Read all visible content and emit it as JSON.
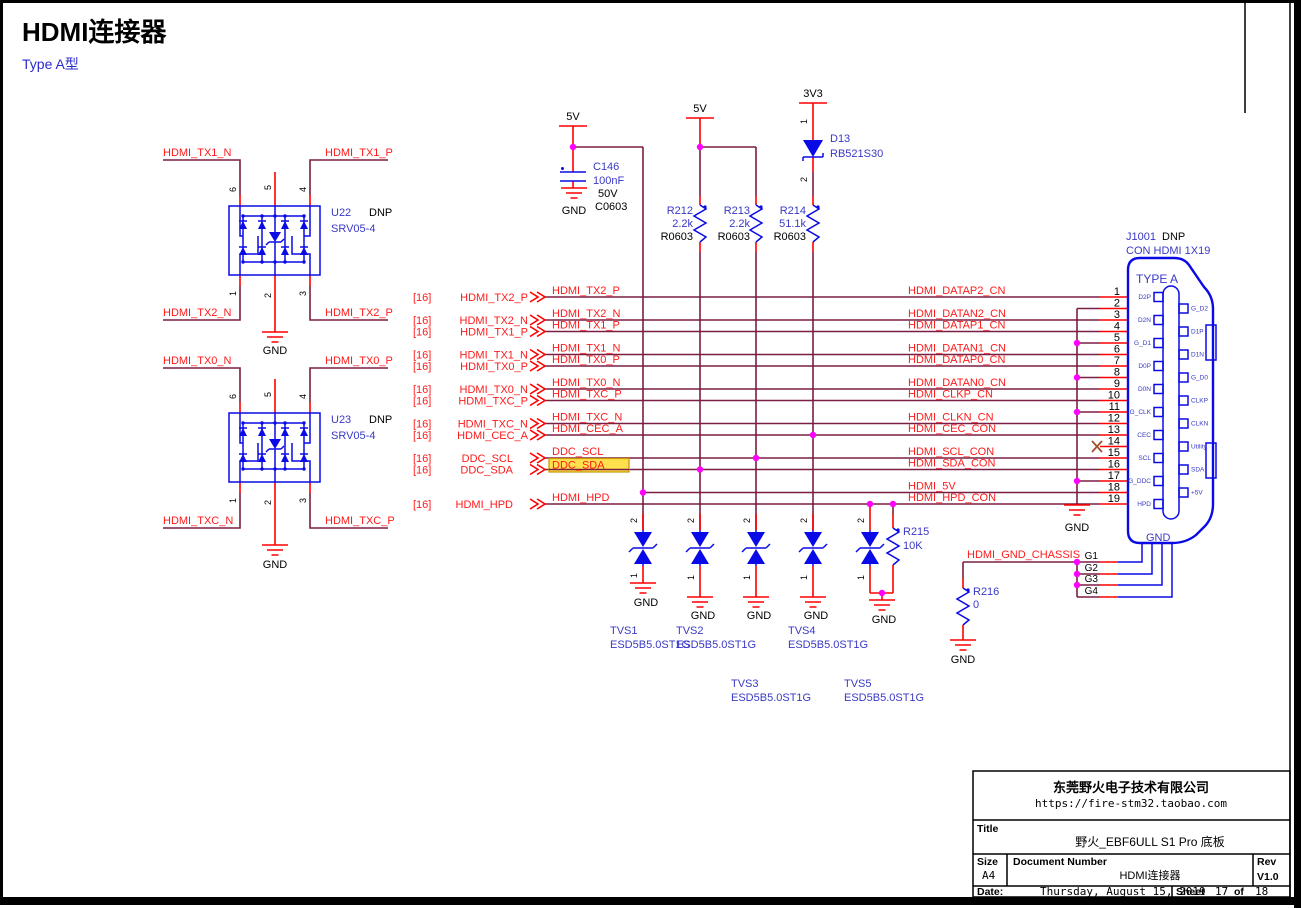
{
  "header": {
    "title": "HDMI连接器",
    "subtitle": "Type A型"
  },
  "labels": {
    "gnd": "GND",
    "dnp": "DNP"
  },
  "power": {
    "v5": "5V",
    "v3v3": "3V3"
  },
  "srv_pins": {
    "p6": "6",
    "p5": "5",
    "p4": "4",
    "p1": "1",
    "p2": "2",
    "p3": "3"
  },
  "u22": {
    "ref": "U22",
    "part": "SRV05-4",
    "net_tl": "HDMI_TX1_N",
    "net_tr": "HDMI_TX1_P",
    "net_bl": "HDMI_TX2_N",
    "net_br": "HDMI_TX2_P"
  },
  "u23": {
    "ref": "U23",
    "part": "SRV05-4",
    "net_tl": "HDMI_TX0_N",
    "net_tr": "HDMI_TX0_P",
    "net_bl": "HDMI_TXC_N",
    "net_br": "HDMI_TXC_P"
  },
  "c146": {
    "ref": "C146",
    "value": "100nF",
    "rating": "50V",
    "footprint": "C0603"
  },
  "r212": {
    "ref": "R212",
    "value": "2.2k",
    "footprint": "R0603"
  },
  "r213": {
    "ref": "R213",
    "value": "2.2k",
    "footprint": "R0603"
  },
  "r214": {
    "ref": "R214",
    "value": "51.1k",
    "footprint": "R0603"
  },
  "r215": {
    "ref": "R215",
    "value": "10K"
  },
  "r216": {
    "ref": "R216",
    "value": "0"
  },
  "d13": {
    "ref": "D13",
    "part": "RB521S30",
    "pin1": "1",
    "pin2": "2"
  },
  "tvs": {
    "pin_top": "2",
    "pin_bottom": "1",
    "items": [
      {
        "ref": "TVS1",
        "part": "ESD5B5.0ST1G"
      },
      {
        "ref": "TVS2",
        "part": "ESD5B5.0ST1G"
      },
      {
        "ref": "TVS3",
        "part": "ESD5B5.0ST1G"
      },
      {
        "ref": "TVS4",
        "part": "ESD5B5.0ST1G"
      },
      {
        "ref": "TVS5",
        "part": "ESD5B5.0ST1G"
      }
    ]
  },
  "offpage": {
    "sheet_ref": "[16]",
    "rows": [
      {
        "name": "HDMI_TX2_P",
        "label": "HDMI_TX2_P"
      },
      {
        "name": "HDMI_TX2_N",
        "label": "HDMI_TX2_N"
      },
      {
        "name": "HDMI_TX1_P",
        "label": "HDMI_TX1_P"
      },
      {
        "name": "HDMI_TX1_N",
        "label": "HDMI_TX1_N"
      },
      {
        "name": "HDMI_TX0_P",
        "label": "HDMI_TX0_P"
      },
      {
        "name": "HDMI_TX0_N",
        "label": "HDMI_TX0_N"
      },
      {
        "name": "HDMI_TXC_P",
        "label": "HDMI_TXC_P"
      },
      {
        "name": "HDMI_TXC_N",
        "label": "HDMI_TXC_N"
      },
      {
        "name": "HDMI_CEC_A",
        "label": "HDMI_CEC_A"
      },
      {
        "name": "DDC_SCL",
        "label": "DDC_SCL"
      },
      {
        "name": "DDC_SDA",
        "label": "DDC_SDA"
      },
      {
        "name": "HDMI_HPD",
        "label": "HDMI_HPD"
      }
    ]
  },
  "right_nets": [
    "HDMI_DATAP2_CN",
    "HDMI_DATAN2_CN",
    "HDMI_DATAP1_CN",
    "HDMI_DATAN1_CN",
    "HDMI_DATAP0_CN",
    "HDMI_DATAN0_CN",
    "HDMI_CLKP_CN",
    "HDMI_CLKN_CN",
    "HDMI_CEC_CON",
    "HDMI_SCL_CON",
    "HDMI_SDA_CON",
    "HDMI_5V",
    "HDMI_HPD_CON"
  ],
  "chassis_net": "HDMI_GND_CHASSIS",
  "connector": {
    "ref": "J1001",
    "dnp": "DNP",
    "part": "CON HDMI 1X19",
    "type_label": "TYPE A",
    "gnd_label": "GND",
    "pins": [
      "1",
      "2",
      "3",
      "4",
      "5",
      "6",
      "7",
      "8",
      "9",
      "10",
      "11",
      "12",
      "13",
      "14",
      "15",
      "16",
      "17",
      "18",
      "19"
    ],
    "left_pads": [
      "D2P",
      "D2N",
      "G_D1",
      "D0P",
      "D0N",
      "G_CLK",
      "CEC",
      "SCL",
      "G_DDC",
      "HPD"
    ],
    "right_pads": [
      "G_D2",
      "D1P",
      "D1N",
      "G_D0",
      "CLKP",
      "CLKN",
      "Utility",
      "SDA",
      "+5V"
    ],
    "gnd_pins": [
      "G1",
      "G2",
      "G3",
      "G4"
    ]
  },
  "titleblock": {
    "company": "东莞野火电子技术有限公司",
    "url": "https://fire-stm32.taobao.com",
    "title_label": "Title",
    "title": "野火_EBF6ULL S1 Pro 底板",
    "size_label": "Size",
    "size": "A4",
    "doc_label": "Document Number",
    "doc": "HDMI连接器",
    "rev_label": "Rev",
    "rev": "V1.0",
    "date_label": "Date:",
    "date": "Thursday, August 15, 2019",
    "sheet_label": "Sheet",
    "sheet": "17",
    "of_label": "of",
    "total": "18"
  }
}
